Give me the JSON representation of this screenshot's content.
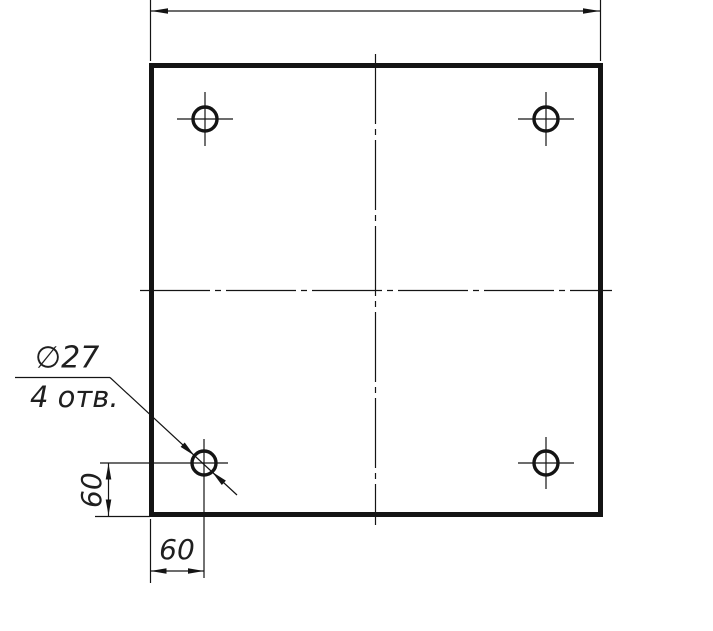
{
  "drawing": {
    "labels": {
      "hole_diameter": "∅27",
      "hole_count": "4 отв.",
      "vertical_offset": "60",
      "horizontal_offset": "60"
    },
    "values": {
      "hole_diameter_mm": 27,
      "hole_count": 4,
      "hole_offset_from_left_edge_mm": 60,
      "hole_offset_from_bottom_edge_mm": 60
    },
    "colors": {
      "line": "#141414",
      "text": "#1f1f1f",
      "background": "#ffffff"
    }
  }
}
